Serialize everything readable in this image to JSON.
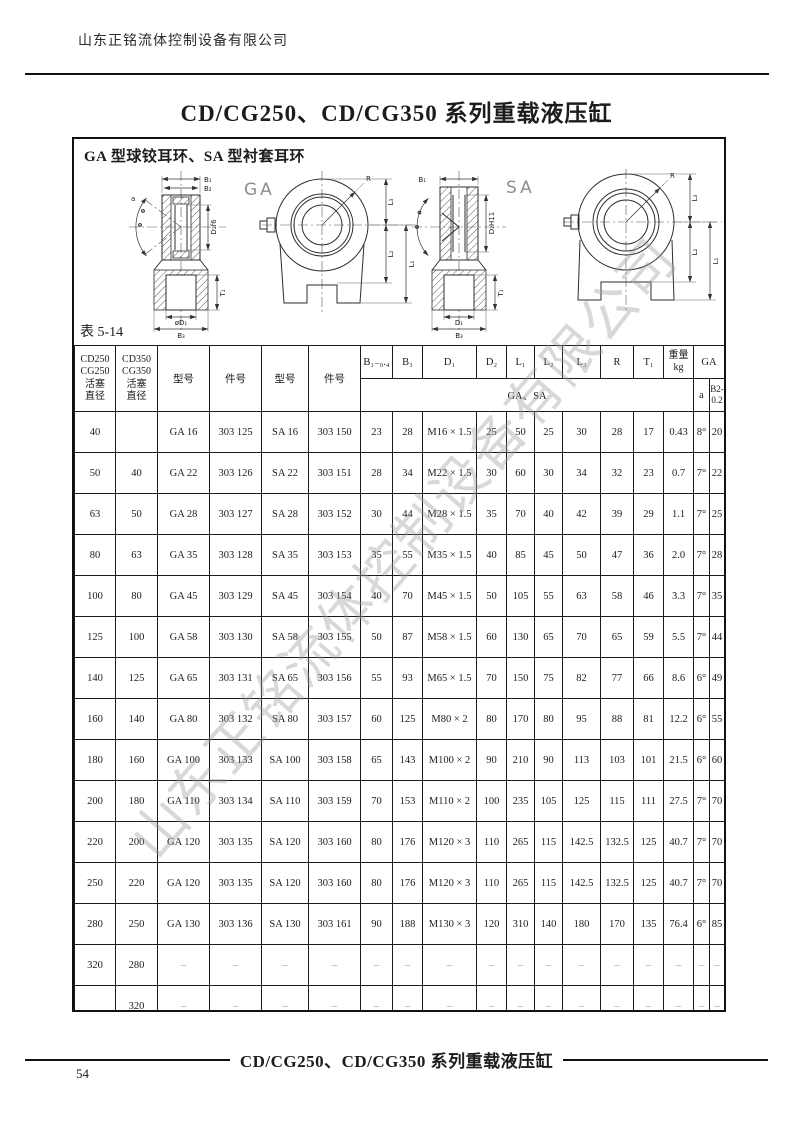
{
  "page": {
    "company": "山东正铭流体控制设备有限公司",
    "title": "CD/CG250、CD/CG350 系列重载液压缸",
    "watermark": "山东正铭流体控制设备有限公司",
    "footer": {
      "title": "CD/CG250、CD/CG350 系列重载液压缸",
      "page_number": "54"
    }
  },
  "figure": {
    "heading": "GA 型球铰耳环、SA 型衬套耳环",
    "table_label": "表 5-14",
    "ga_title": "GA",
    "sa_title": "SA",
    "labels": {
      "b1": "B₁",
      "b2": "B₂",
      "b3": "B₃",
      "d1_ga": "øD₁",
      "d1_sa": "D₁",
      "d2_ga": "D₂f6",
      "d2_sa": "D₂H11",
      "t1": "T₁",
      "r": "R",
      "l1": "L₁",
      "l2": "L₂",
      "l3": "L₃",
      "angle": "a"
    }
  },
  "table": {
    "header": {
      "piston_250": "CD250\nCG250\n活塞\n直径",
      "piston_350": "CD350\nCG350\n活塞\n直径",
      "model_ga": "型号",
      "part_ga": "件号",
      "model_sa": "型号",
      "part_sa": "件号",
      "b1": "B₁₋₀.₄",
      "b3": "B₃",
      "d1": "D₁",
      "d2": "D₂",
      "l1": "L₁",
      "l2": "L₂",
      "l3": "L₃",
      "r": "R",
      "t1": "T₁",
      "weight": "重量\nkg",
      "ga": "GA",
      "ga_sa": "GA、SA",
      "a": "a",
      "b2": "B2-\n0.2"
    },
    "rows": [
      [
        "40",
        "",
        "GA 16",
        "303 125",
        "SA 16",
        "303 150",
        "23",
        "28",
        "M16 × 1.5",
        "25",
        "50",
        "25",
        "30",
        "28",
        "17",
        "0.43",
        "8°",
        "20"
      ],
      [
        "50",
        "40",
        "GA 22",
        "303 126",
        "SA 22",
        "303 151",
        "28",
        "34",
        "M22 × 1.5",
        "30",
        "60",
        "30",
        "34",
        "32",
        "23",
        "0.7",
        "7°",
        "22"
      ],
      [
        "63",
        "50",
        "GA 28",
        "303 127",
        "SA 28",
        "303 152",
        "30",
        "44",
        "M28 × 1.5",
        "35",
        "70",
        "40",
        "42",
        "39",
        "29",
        "1.1",
        "7°",
        "25"
      ],
      [
        "80",
        "63",
        "GA 35",
        "303 128",
        "SA 35",
        "303 153",
        "35",
        "55",
        "M35 × 1.5",
        "40",
        "85",
        "45",
        "50",
        "47",
        "36",
        "2.0",
        "7°",
        "28"
      ],
      [
        "100",
        "80",
        "GA 45",
        "303 129",
        "SA 45",
        "303 154",
        "40",
        "70",
        "M45 × 1.5",
        "50",
        "105",
        "55",
        "63",
        "58",
        "46",
        "3.3",
        "7°",
        "35"
      ],
      [
        "125",
        "100",
        "GA 58",
        "303 130",
        "SA 58",
        "303 155",
        "50",
        "87",
        "M58 × 1.5",
        "60",
        "130",
        "65",
        "70",
        "65",
        "59",
        "5.5",
        "7°",
        "44"
      ],
      [
        "140",
        "125",
        "GA 65",
        "303 131",
        "SA 65",
        "303 156",
        "55",
        "93",
        "M65 × 1.5",
        "70",
        "150",
        "75",
        "82",
        "77",
        "66",
        "8.6",
        "6°",
        "49"
      ],
      [
        "160",
        "140",
        "GA 80",
        "303 132",
        "SA 80",
        "303 157",
        "60",
        "125",
        "M80 × 2",
        "80",
        "170",
        "80",
        "95",
        "88",
        "81",
        "12.2",
        "6°",
        "55"
      ],
      [
        "180",
        "160",
        "GA 100",
        "303 133",
        "SA 100",
        "303 158",
        "65",
        "143",
        "M100 × 2",
        "90",
        "210",
        "90",
        "113",
        "103",
        "101",
        "21.5",
        "6°",
        "60"
      ],
      [
        "200",
        "180",
        "GA 110",
        "303 134",
        "SA 110",
        "303 159",
        "70",
        "153",
        "M110 × 2",
        "100",
        "235",
        "105",
        "125",
        "115",
        "111",
        "27.5",
        "7°",
        "70"
      ],
      [
        "220",
        "200",
        "GA 120",
        "303 135",
        "SA 120",
        "303 160",
        "80",
        "176",
        "M120 × 3",
        "110",
        "265",
        "115",
        "142.5",
        "132.5",
        "125",
        "40.7",
        "7°",
        "70"
      ],
      [
        "250",
        "220",
        "GA 120",
        "303 135",
        "SA 120",
        "303 160",
        "80",
        "176",
        "M120 × 3",
        "110",
        "265",
        "115",
        "142.5",
        "132.5",
        "125",
        "40.7",
        "7°",
        "70"
      ],
      [
        "280",
        "250",
        "GA 130",
        "303 136",
        "SA 130",
        "303 161",
        "90",
        "188",
        "M130 × 3",
        "120",
        "310",
        "140",
        "180",
        "170",
        "135",
        "76.4",
        "6°",
        "85"
      ],
      [
        "320",
        "280",
        "–",
        "–",
        "–",
        "–",
        "–",
        "–",
        "–",
        "–",
        "–",
        "–",
        "–",
        "–",
        "–",
        "–",
        "–",
        "–"
      ],
      [
        "",
        "320",
        "–",
        "–",
        "–",
        "–",
        "–",
        "–",
        "–",
        "–",
        "–",
        "–",
        "–",
        "–",
        "–",
        "–",
        "–",
        "–"
      ]
    ]
  }
}
